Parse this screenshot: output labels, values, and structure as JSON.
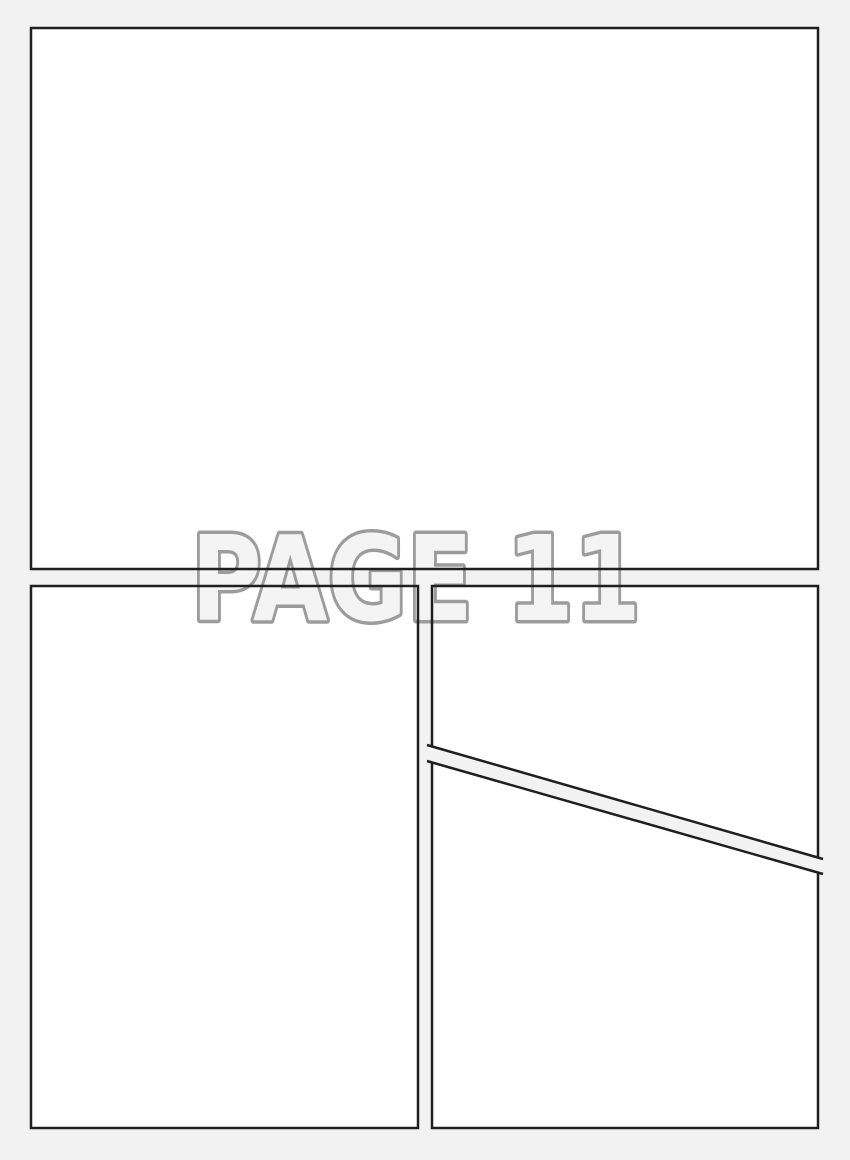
{
  "page": {
    "label": "PAGE 11"
  },
  "colors": {
    "page_background": "#f2f2f2",
    "panel_fill": "#ffffff",
    "panel_border": "#1f1f1f",
    "label_fill": "#f4f4f4",
    "label_outline": "#9c9c9c"
  },
  "panels": [
    {
      "name": "top full-width panel"
    },
    {
      "name": "bottom-left tall panel"
    },
    {
      "name": "bottom-right upper panel above diagonal gutter"
    },
    {
      "name": "bottom-right lower panel below diagonal gutter"
    }
  ]
}
